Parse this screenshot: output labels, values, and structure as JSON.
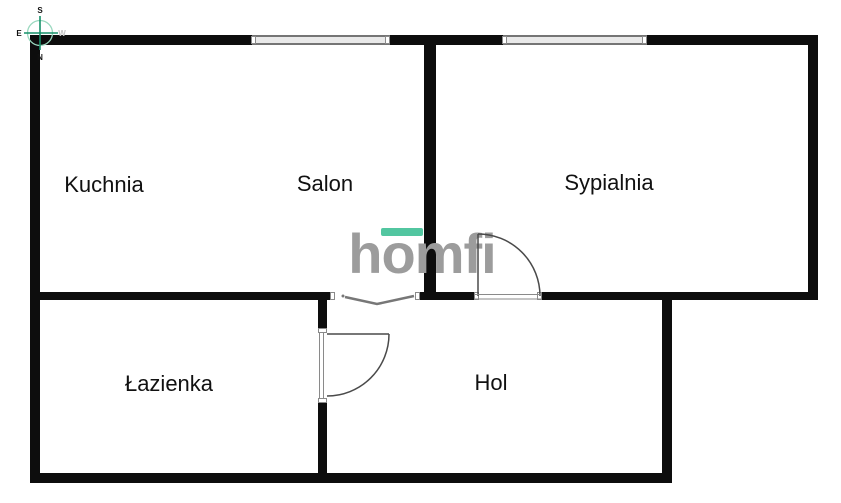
{
  "rooms": [
    {
      "id": "kuchnia",
      "label": "Kuchnia"
    },
    {
      "id": "salon",
      "label": "Salon"
    },
    {
      "id": "sypialnia",
      "label": "Sypialnia"
    },
    {
      "id": "lazienka",
      "label": "Łazienka"
    },
    {
      "id": "hol",
      "label": "Hol"
    }
  ],
  "watermark": {
    "text": "homfi",
    "text_color": "#9c9c9c",
    "accent_bar_color": "#52c6a0"
  },
  "compass": {
    "top": "S",
    "bottom": "N",
    "left": "E",
    "right": "W",
    "cross_color": "#17916a",
    "circle_color": "#9ad8bf"
  },
  "colors": {
    "background": "#ffffff",
    "wall": "#0d0d0d",
    "door_line": "#4a4a4a",
    "window_fill": "#e9e9e9",
    "window_frame": "#757575"
  },
  "icons": {
    "compass": "compass-rose-icon"
  }
}
